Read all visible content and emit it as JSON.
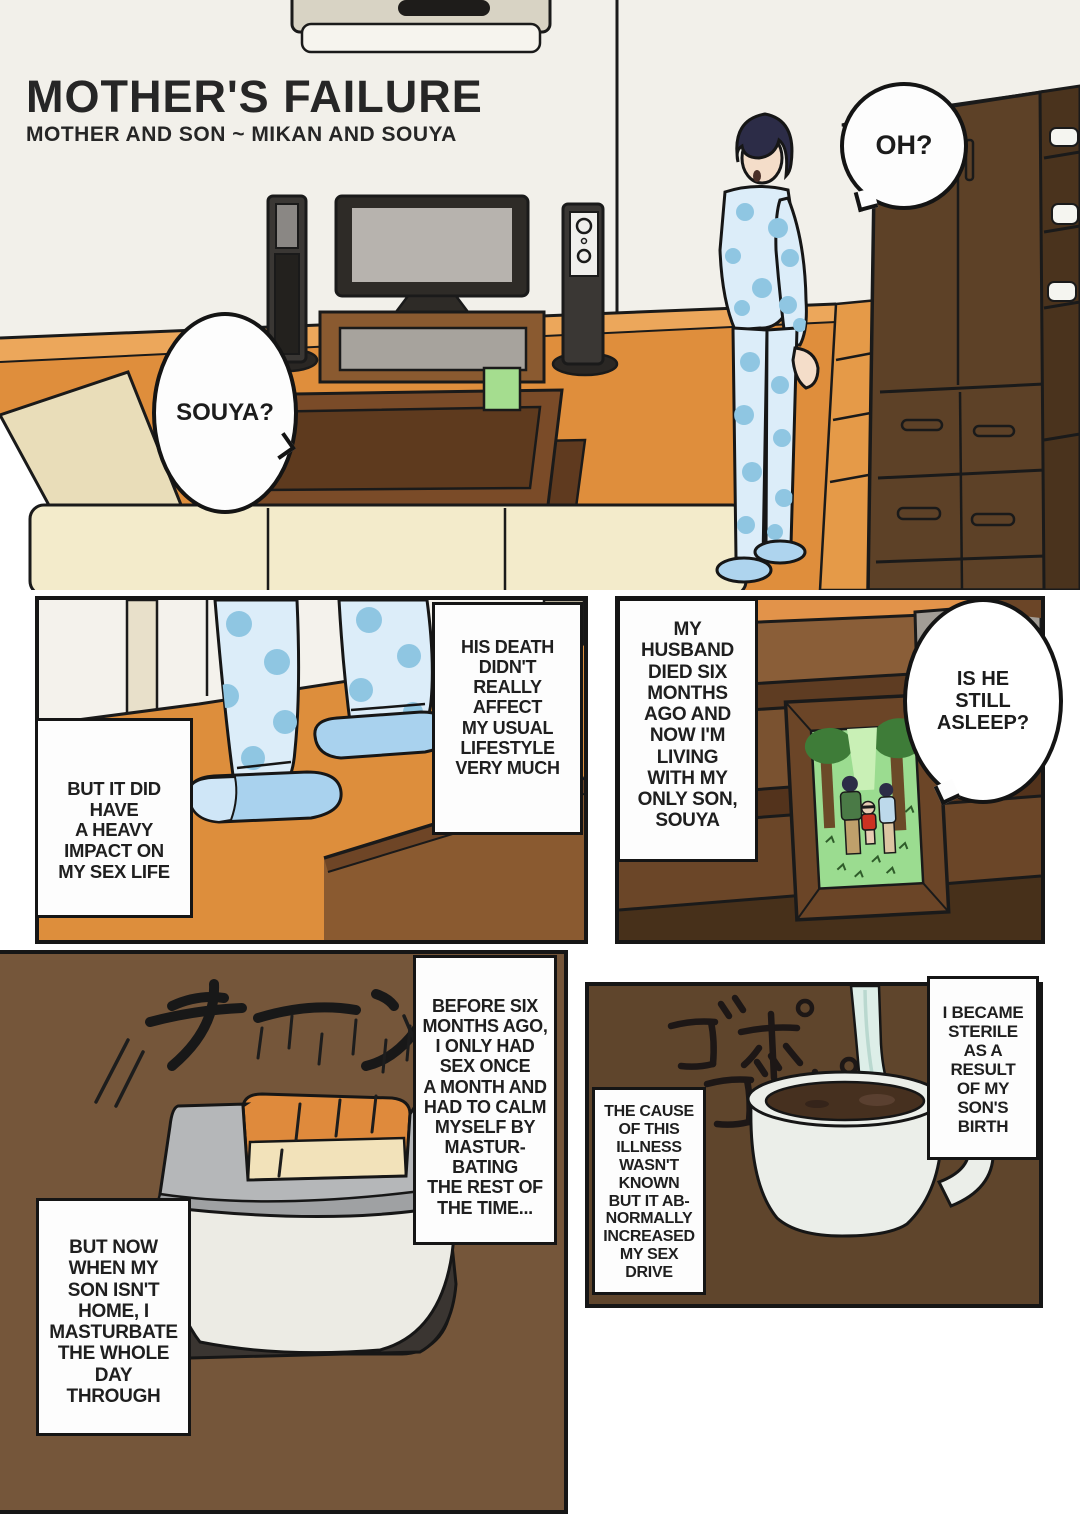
{
  "page": {
    "title": "MOTHER'S FAILURE",
    "subtitle": "MOTHER AND SON ~ MIKAN AND SOUYA"
  },
  "bubbles": {
    "oh": "OH?",
    "souya": "SOUYA?",
    "asleep": "IS HE\nSTILL\nASLEEP?"
  },
  "narration": {
    "his_death": "HIS DEATH\nDIDN'T\nREALLY\nAFFECT\nMY USUAL\nLIFESTYLE\nVERY MUCH",
    "impact": "BUT IT DID\nHAVE\nA HEAVY\nIMPACT ON\nMY SEX LIFE",
    "husband": "MY\nHUSBAND\nDIED SIX\nMONTHS\nAGO AND\nNOW I'M\nLIVING\nWITH MY\nONLY SON,\nSOUYA",
    "before": "BEFORE SIX\nMONTHS AGO,\nI ONLY HAD\nSEX ONCE\nA MONTH AND\nHAD TO CALM\nMYSELF BY\nMASTUR-\nBATING\nTHE REST OF\nTHE TIME...",
    "but_now": "BUT NOW\nWHEN MY\nSON ISN'T\nHOME, I\nMASTURBATE\nTHE WHOLE\nDAY\nTHROUGH",
    "cause": "THE CAUSE\nOF THIS\nILLNESS\nWASN'T\nKNOWN\nBUT IT AB-\nNORMALLY\nINCREASED\nMY SEX\nDRIVE",
    "sterile": "I BECAME\nSTERILE\nAS A\nRESULT\nOF MY\nSON'S\nBIRTH"
  },
  "sfx": {
    "toaster_ding": "チーン",
    "pouring_1": "ゴポ",
    "pouring_2": "ゴポ"
  },
  "colors": {
    "floor_orange": "#df8e3c",
    "wood_dark_brown": "#5d4127",
    "panel_brown_light": "#75563a",
    "panel_brown_dark": "#5f452c",
    "pajama_blue": "#dcedf9",
    "pajama_dot_blue": "#8fc6e2",
    "outline_black": "#161616"
  }
}
